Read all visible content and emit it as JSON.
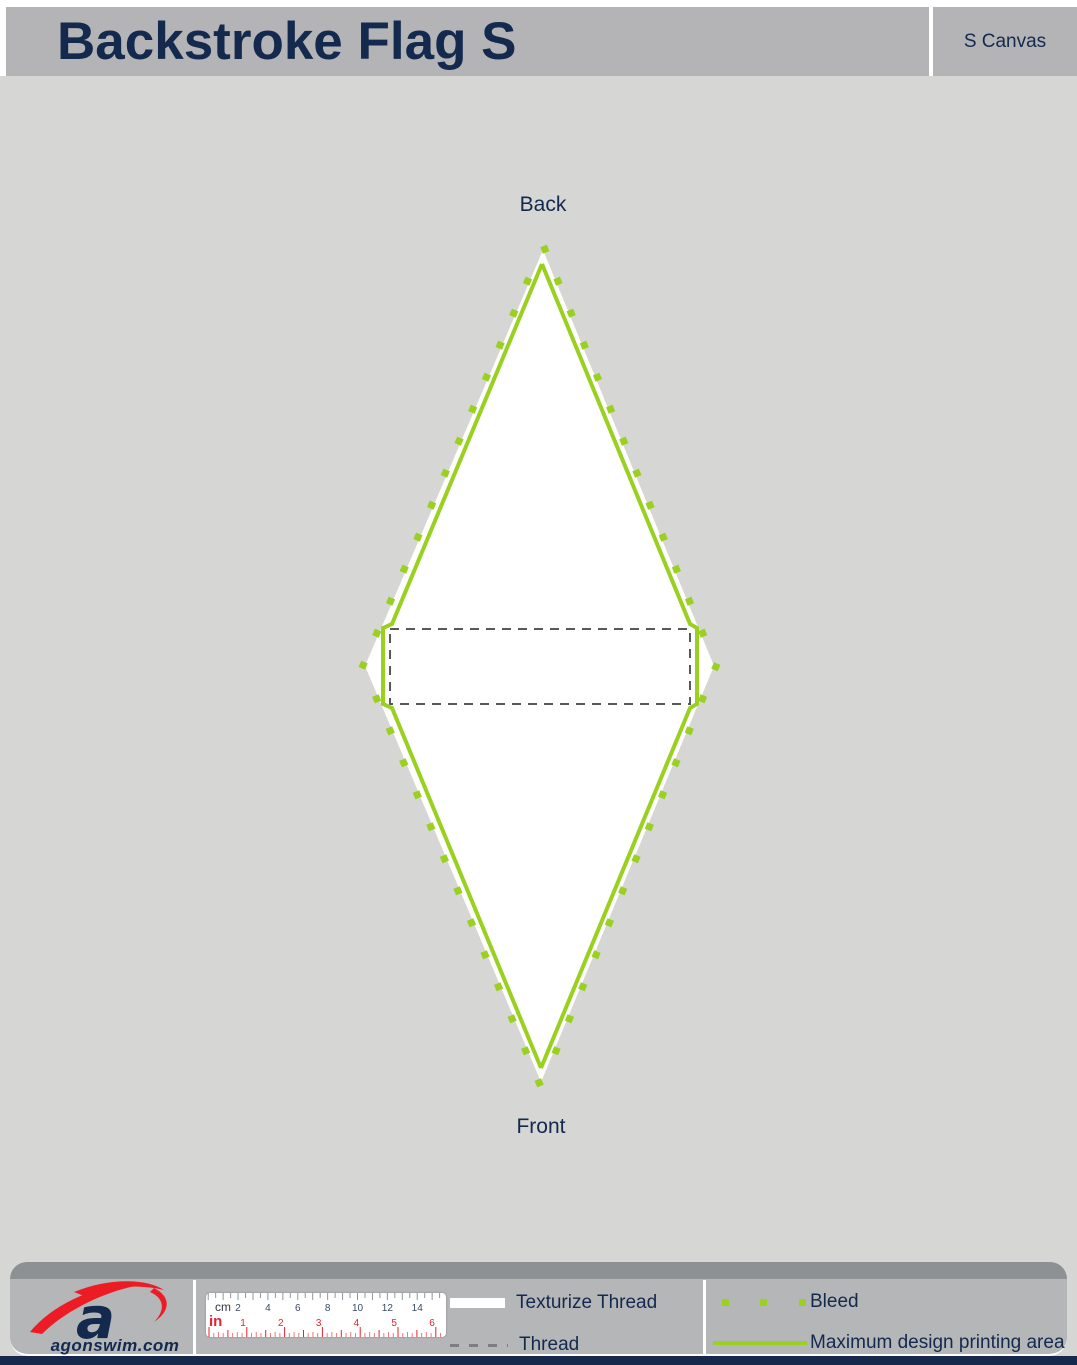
{
  "header": {
    "title": "Backstroke Flag S",
    "canvas_label": "S Canvas"
  },
  "figure": {
    "back_label": "Back",
    "front_label": "Front"
  },
  "footer": {
    "logo_text": "agonswim.com",
    "ruler": {
      "cm_label": "cm",
      "in_label": "in",
      "cm_numbers": [
        "2",
        "4",
        "6",
        "8",
        "10",
        "12",
        "14"
      ],
      "in_numbers": [
        "1",
        "2",
        "3",
        "4",
        "5",
        "6"
      ]
    },
    "legend": [
      {
        "key": "texturize-thread",
        "label": "Texturize Thread"
      },
      {
        "key": "thread",
        "label": "Thread"
      },
      {
        "key": "bleed",
        "label": "Bleed"
      },
      {
        "key": "max-print",
        "label": "Maximum design printing area"
      }
    ]
  },
  "colors": {
    "accent_green": "#9AD020",
    "navy": "#13294E",
    "header_gray": "#B4B4B6",
    "body_gray": "#D6D6D4",
    "footer_gray": "#B5B6B8",
    "footer_band_gray": "#8E9193",
    "thread_dash_gray": "#58595B",
    "legend_dash_gray": "#7C7E80",
    "ruler_red": "#E8212E",
    "ruler_tick_gray": "#8C96A6",
    "ruler_number_navy": "#3A4A63",
    "logo_red": "#ED1C24",
    "bottom_bar_navy": "#16294C",
    "flag_white": "#FFFFFF"
  }
}
